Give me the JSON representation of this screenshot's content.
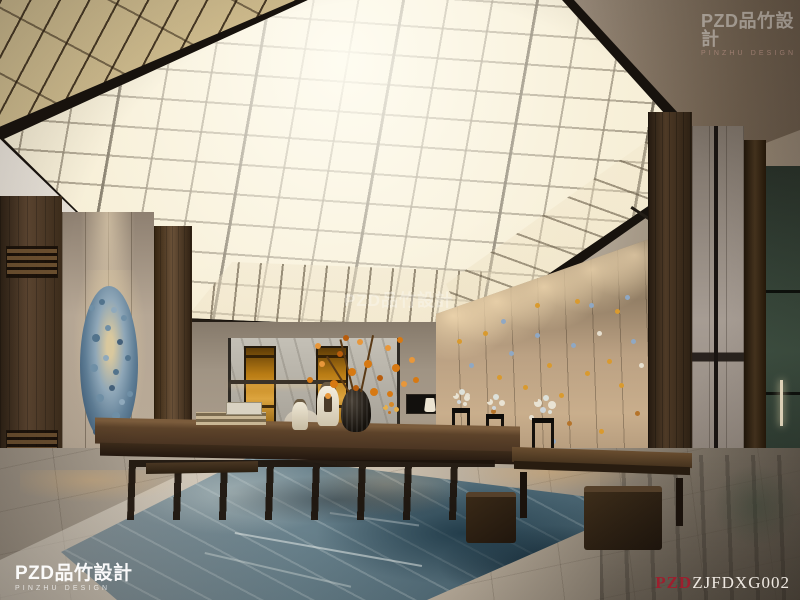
{
  "scene": {
    "description": "Photorealistic interior rendering of a lobby tea room with a large illuminated grid skylight ceiling, beige paneled walls, blue coral wall art, butterfly art wall, long dark wood tea table with orange flower arrangement, blue abstract rug on polished marble floor"
  },
  "watermarks": {
    "center_text": "PZD品竹設計",
    "corner_brand": "PZD品竹設計",
    "corner_subtitle": "PINZHU DESIGN",
    "code_prefix": "PZD",
    "code_text": "ZJFDXG002"
  },
  "palette": {
    "ceiling_glow": "#f2e8cd",
    "ceiling_grid_line": "#6e6250",
    "gold_lattice": "#c3ad7c",
    "wall_beige": "#b7a78e",
    "wood_dark": "#4a3826",
    "accent_orange": "#d77912",
    "coral_art_blue": "#5f7e96",
    "rug_blue": "#5d7582",
    "floor_marble": "#b5aa9a",
    "alcove_green": "#3d4f41",
    "code_red": "#9c1f2e"
  }
}
